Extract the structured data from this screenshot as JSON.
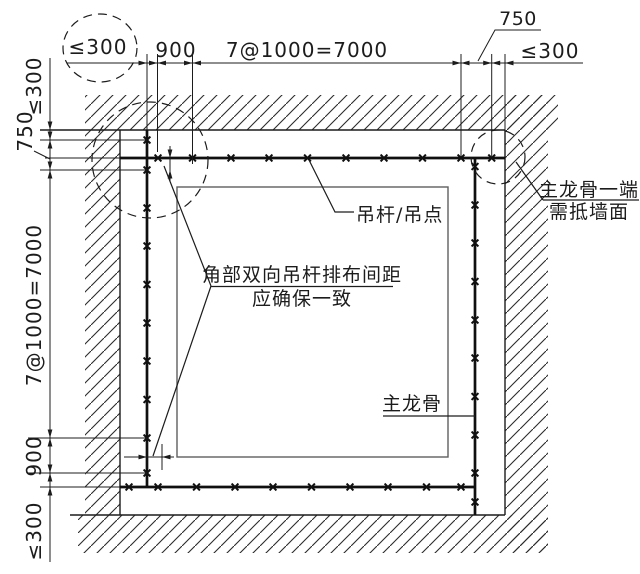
{
  "drawing": {
    "dimensions": {
      "top": {
        "wall_gap": "≤300",
        "first_spacing": "900",
        "run": "7@1000=7000",
        "end_spacing": "750",
        "end_gap": "≤300"
      },
      "left": {
        "wall_gap": "≤300",
        "first_spacing": "750",
        "run": "7@1000=7000",
        "end_spacing": "900",
        "end_gap": "≤300"
      }
    },
    "annotations": {
      "hanger_point": "吊杆/吊点",
      "corner_note_line1": "角部双向吊杆排布间距",
      "corner_note_line2": "应确保一致",
      "main_keel": "主龙骨",
      "keel_end_note_line1": "主龙骨一端",
      "keel_end_note_line2": "需抵墙面"
    },
    "colors": {
      "ink": "#1c1c1c",
      "background": "#ffffff"
    }
  }
}
